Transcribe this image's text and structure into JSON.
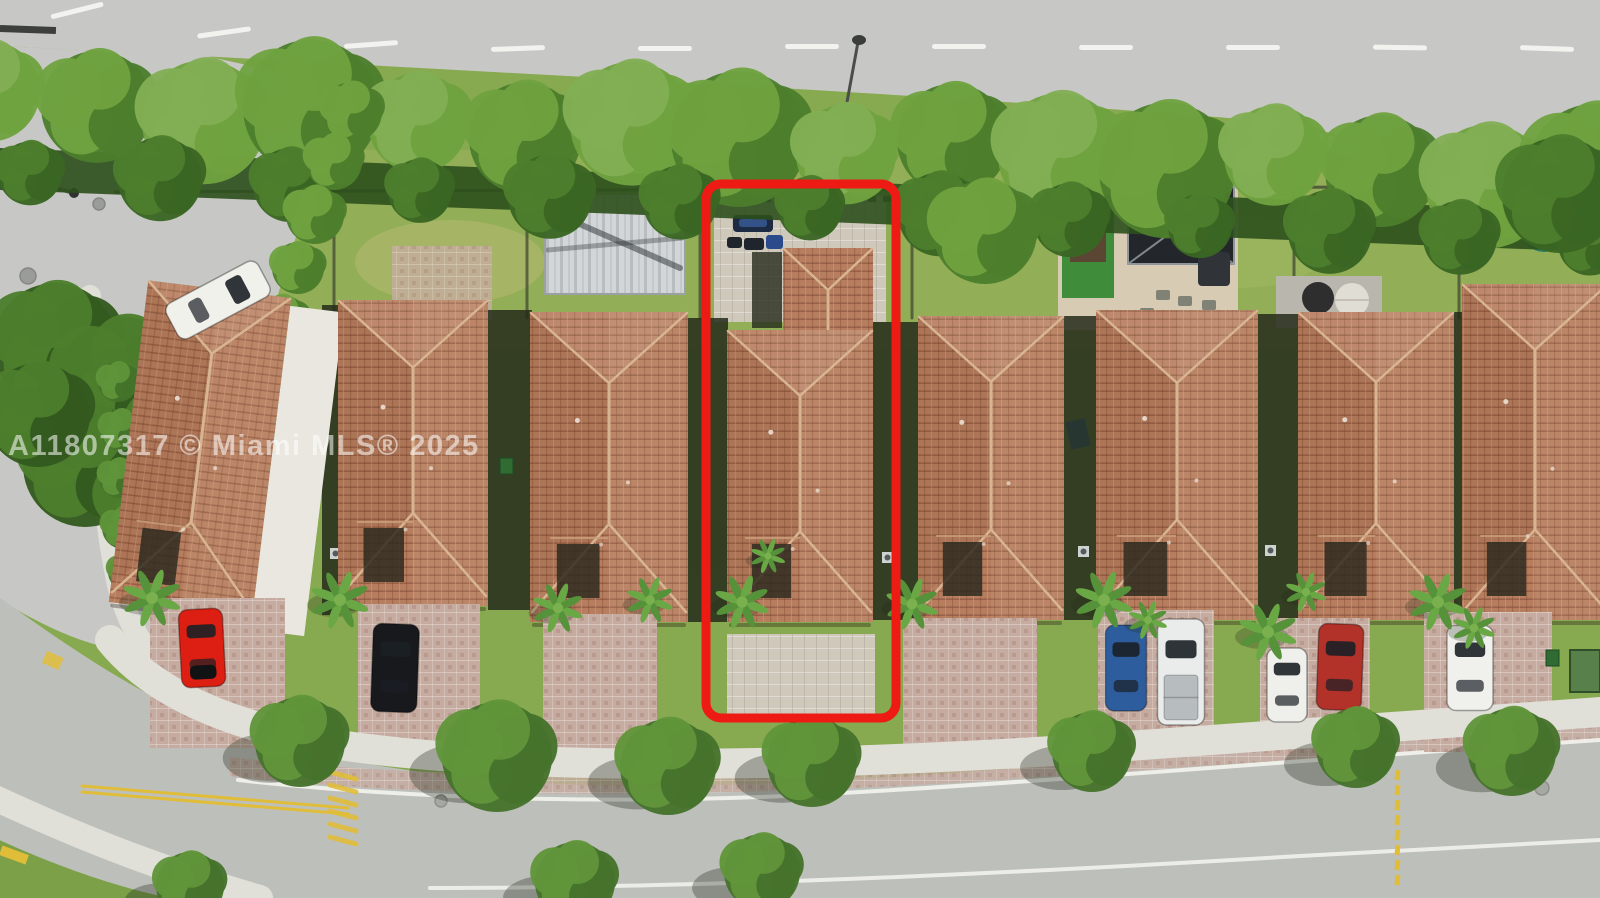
{
  "meta": {
    "type": "aerial-drone-photo",
    "description": "Overhead aerial view of a row of eight single-family homes with terracotta tile roofs between a rear road with hedge and a front residential street; the subject narrow lot is outlined with a red rounded rectangle"
  },
  "watermark": {
    "text": "A11807317 © Miami MLS® 2025"
  },
  "scene": {
    "highlight_box": {
      "name": "subject-property-outline",
      "color": "#ee1b15"
    },
    "houses_count": 8,
    "vehicles": [
      {
        "name": "white-car-side-street",
        "color": "#f1f1ec"
      },
      {
        "name": "red-sports-car",
        "color": "#dd1f13"
      },
      {
        "name": "black-sedan",
        "color": "#17191d"
      },
      {
        "name": "covered-items-rear-patio",
        "color": "#1d2a44"
      },
      {
        "name": "blue-suv",
        "color": "#2e5d9e"
      },
      {
        "name": "white-pickup-truck",
        "color": "#e9eceb"
      },
      {
        "name": "white-sedan",
        "color": "#eff0ec"
      },
      {
        "name": "red-sedan",
        "color": "#b23129"
      },
      {
        "name": "white-sedan-right",
        "color": "#f0f1ed"
      }
    ],
    "umbrellas": [
      {
        "name": "black-patio-umbrella",
        "color": "#2e2e2e"
      },
      {
        "name": "white-patio-umbrella",
        "color": "#e0ddd5"
      },
      {
        "name": "blue-patio-umbrella",
        "color": "#2c4e92"
      },
      {
        "name": "teal-patio-umbrella",
        "color": "#2c7a69"
      }
    ]
  },
  "colors": {
    "highlight_red": "#ee1b15",
    "roof_tile": "#b67d5f",
    "roof_ridge": "#d8b592",
    "grass": "#87a94f",
    "grass_light": "#9ab25c",
    "hedge_dark": "#2c4f1c",
    "tree_mid": "#4c7e2d",
    "tree_light": "#6fa23f",
    "road": "#c7c8c5",
    "street": "#bdbfba",
    "sidewalk": "#e0dfd8",
    "paver": "#c3a093",
    "driveway": "#c6aca0",
    "courtyard": "#cfc9bc",
    "yellow": "#e0bd39",
    "white_line": "#f4f4f0",
    "fence": "#3c4130",
    "shadow": "#262b1b",
    "watermark": "rgba(255,255,255,0.55)"
  }
}
